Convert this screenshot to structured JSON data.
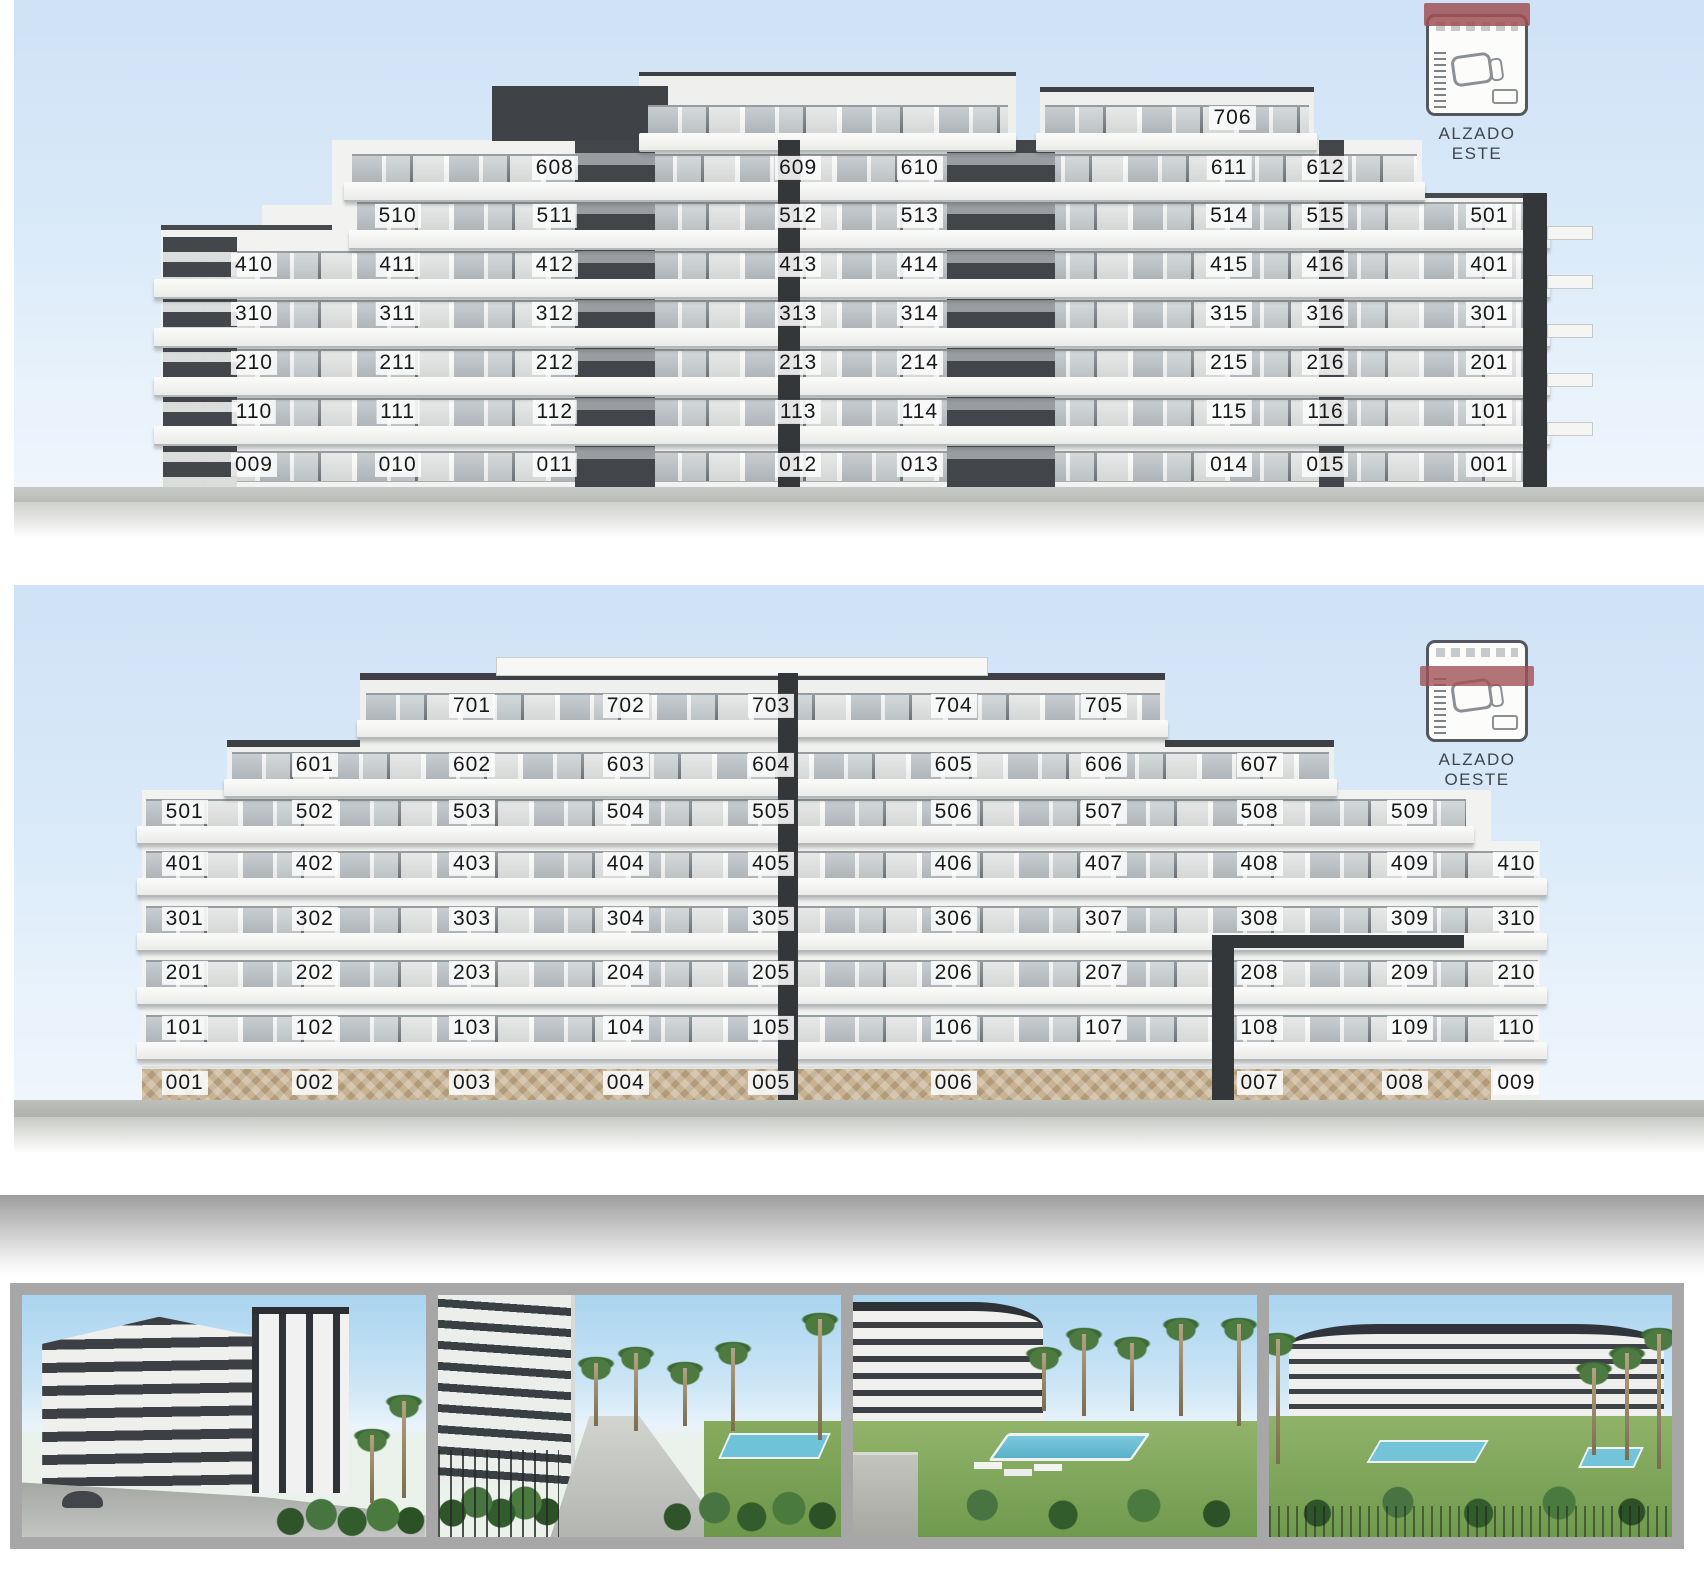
{
  "colors": {
    "sky": "#d6e7f7",
    "charcoal": "#3d4145",
    "white_band": "#f2f3f1",
    "glass": "#b9c0c4",
    "stone": "#c7b291",
    "key_plan_red": "#a05156",
    "ground": "#c2c6c2",
    "photo_strip_bg": "#a7a7a7"
  },
  "elevations": [
    {
      "id": "este",
      "key_label": "ALZADO ESTE",
      "floors": [
        {
          "level": "7",
          "y": 21.7,
          "units": [
            {
              "n": "706",
              "x": 72.1
            }
          ]
        },
        {
          "level": "6",
          "y": 30.8,
          "units": [
            {
              "n": "608",
              "x": 32.0
            },
            {
              "n": "609",
              "x": 46.4
            },
            {
              "n": "610",
              "x": 53.6
            },
            {
              "n": "611",
              "x": 71.9
            },
            {
              "n": "612",
              "x": 77.6
            }
          ]
        },
        {
          "level": "5",
          "y": 39.6,
          "units": [
            {
              "n": "510",
              "x": 22.7
            },
            {
              "n": "511",
              "x": 32.0
            },
            {
              "n": "512",
              "x": 46.4
            },
            {
              "n": "513",
              "x": 53.6
            },
            {
              "n": "514",
              "x": 71.9
            },
            {
              "n": "515",
              "x": 77.6
            },
            {
              "n": "501",
              "x": 87.3
            }
          ]
        },
        {
          "level": "4",
          "y": 48.6,
          "units": [
            {
              "n": "410",
              "x": 14.2
            },
            {
              "n": "411",
              "x": 22.7
            },
            {
              "n": "412",
              "x": 32.0
            },
            {
              "n": "413",
              "x": 46.4
            },
            {
              "n": "414",
              "x": 53.6
            },
            {
              "n": "415",
              "x": 71.9
            },
            {
              "n": "416",
              "x": 77.6
            },
            {
              "n": "401",
              "x": 87.3
            }
          ]
        },
        {
          "level": "3",
          "y": 57.6,
          "units": [
            {
              "n": "310",
              "x": 14.2
            },
            {
              "n": "311",
              "x": 22.7
            },
            {
              "n": "312",
              "x": 32.0
            },
            {
              "n": "313",
              "x": 46.4
            },
            {
              "n": "314",
              "x": 53.6
            },
            {
              "n": "315",
              "x": 71.9
            },
            {
              "n": "316",
              "x": 77.6
            },
            {
              "n": "301",
              "x": 87.3
            }
          ]
        },
        {
          "level": "2",
          "y": 66.6,
          "units": [
            {
              "n": "210",
              "x": 14.2
            },
            {
              "n": "211",
              "x": 22.7
            },
            {
              "n": "212",
              "x": 32.0
            },
            {
              "n": "213",
              "x": 46.4
            },
            {
              "n": "214",
              "x": 53.6
            },
            {
              "n": "215",
              "x": 71.9
            },
            {
              "n": "216",
              "x": 77.6
            },
            {
              "n": "201",
              "x": 87.3
            }
          ]
        },
        {
          "level": "1",
          "y": 75.6,
          "units": [
            {
              "n": "110",
              "x": 14.2
            },
            {
              "n": "111",
              "x": 22.7
            },
            {
              "n": "112",
              "x": 32.0
            },
            {
              "n": "113",
              "x": 46.4
            },
            {
              "n": "114",
              "x": 53.6
            },
            {
              "n": "115",
              "x": 71.9
            },
            {
              "n": "116",
              "x": 77.6
            },
            {
              "n": "101",
              "x": 87.3
            }
          ]
        },
        {
          "level": "0",
          "y": 85.3,
          "units": [
            {
              "n": "009",
              "x": 14.2
            },
            {
              "n": "010",
              "x": 22.7
            },
            {
              "n": "011",
              "x": 32.0
            },
            {
              "n": "012",
              "x": 46.4
            },
            {
              "n": "013",
              "x": 53.6
            },
            {
              "n": "014",
              "x": 71.9
            },
            {
              "n": "015",
              "x": 77.6
            },
            {
              "n": "001",
              "x": 87.3
            }
          ]
        }
      ]
    },
    {
      "id": "oeste",
      "key_label": "ALZADO OESTE",
      "floors": [
        {
          "level": "7",
          "y": 21.0,
          "units": [
            {
              "n": "701",
              "x": 27.1
            },
            {
              "n": "702",
              "x": 36.2
            },
            {
              "n": "703",
              "x": 44.8
            },
            {
              "n": "704",
              "x": 55.6
            },
            {
              "n": "705",
              "x": 64.5
            }
          ]
        },
        {
          "level": "6",
          "y": 31.3,
          "units": [
            {
              "n": "601",
              "x": 17.8
            },
            {
              "n": "602",
              "x": 27.1
            },
            {
              "n": "603",
              "x": 36.2
            },
            {
              "n": "604",
              "x": 44.8
            },
            {
              "n": "605",
              "x": 55.6
            },
            {
              "n": "606",
              "x": 64.5
            },
            {
              "n": "607",
              "x": 73.7
            }
          ]
        },
        {
          "level": "5",
          "y": 39.5,
          "units": [
            {
              "n": "501",
              "x": 10.1
            },
            {
              "n": "502",
              "x": 17.8
            },
            {
              "n": "503",
              "x": 27.1
            },
            {
              "n": "504",
              "x": 36.2
            },
            {
              "n": "505",
              "x": 44.8
            },
            {
              "n": "506",
              "x": 55.6
            },
            {
              "n": "507",
              "x": 64.5
            },
            {
              "n": "508",
              "x": 73.7
            },
            {
              "n": "509",
              "x": 82.6
            }
          ]
        },
        {
          "level": "4",
          "y": 48.5,
          "units": [
            {
              "n": "401",
              "x": 10.1
            },
            {
              "n": "402",
              "x": 17.8
            },
            {
              "n": "403",
              "x": 27.1
            },
            {
              "n": "404",
              "x": 36.2
            },
            {
              "n": "405",
              "x": 44.8
            },
            {
              "n": "406",
              "x": 55.6
            },
            {
              "n": "407",
              "x": 64.5
            },
            {
              "n": "408",
              "x": 73.7
            },
            {
              "n": "409",
              "x": 82.6
            },
            {
              "n": "410",
              "x": 88.9
            }
          ]
        },
        {
          "level": "3",
          "y": 58.1,
          "units": [
            {
              "n": "301",
              "x": 10.1
            },
            {
              "n": "302",
              "x": 17.8
            },
            {
              "n": "303",
              "x": 27.1
            },
            {
              "n": "304",
              "x": 36.2
            },
            {
              "n": "305",
              "x": 44.8
            },
            {
              "n": "306",
              "x": 55.6
            },
            {
              "n": "307",
              "x": 64.5
            },
            {
              "n": "308",
              "x": 73.7
            },
            {
              "n": "309",
              "x": 82.6
            },
            {
              "n": "310",
              "x": 88.9
            }
          ]
        },
        {
          "level": "2",
          "y": 67.5,
          "units": [
            {
              "n": "201",
              "x": 10.1
            },
            {
              "n": "202",
              "x": 17.8
            },
            {
              "n": "203",
              "x": 27.1
            },
            {
              "n": "204",
              "x": 36.2
            },
            {
              "n": "205",
              "x": 44.8
            },
            {
              "n": "206",
              "x": 55.6
            },
            {
              "n": "207",
              "x": 64.5
            },
            {
              "n": "208",
              "x": 73.7
            },
            {
              "n": "209",
              "x": 82.6
            },
            {
              "n": "210",
              "x": 88.9
            }
          ]
        },
        {
          "level": "1",
          "y": 77.0,
          "units": [
            {
              "n": "101",
              "x": 10.1
            },
            {
              "n": "102",
              "x": 17.8
            },
            {
              "n": "103",
              "x": 27.1
            },
            {
              "n": "104",
              "x": 36.2
            },
            {
              "n": "105",
              "x": 44.8
            },
            {
              "n": "106",
              "x": 55.6
            },
            {
              "n": "107",
              "x": 64.5
            },
            {
              "n": "108",
              "x": 73.7
            },
            {
              "n": "109",
              "x": 82.6
            },
            {
              "n": "110",
              "x": 88.9
            }
          ]
        },
        {
          "level": "0",
          "y": 86.6,
          "units": [
            {
              "n": "001",
              "x": 10.1
            },
            {
              "n": "002",
              "x": 17.8
            },
            {
              "n": "003",
              "x": 27.1
            },
            {
              "n": "004",
              "x": 36.2
            },
            {
              "n": "005",
              "x": 44.8
            },
            {
              "n": "006",
              "x": 55.6
            },
            {
              "n": "007",
              "x": 73.7
            },
            {
              "n": "008",
              "x": 82.3
            },
            {
              "n": "009",
              "x": 88.9
            }
          ]
        }
      ]
    }
  ],
  "photos": [
    {
      "name": "render-corner-street-view"
    },
    {
      "name": "render-garden-path-view"
    },
    {
      "name": "render-pool-lawn-view"
    },
    {
      "name": "render-wide-garden-view"
    }
  ]
}
